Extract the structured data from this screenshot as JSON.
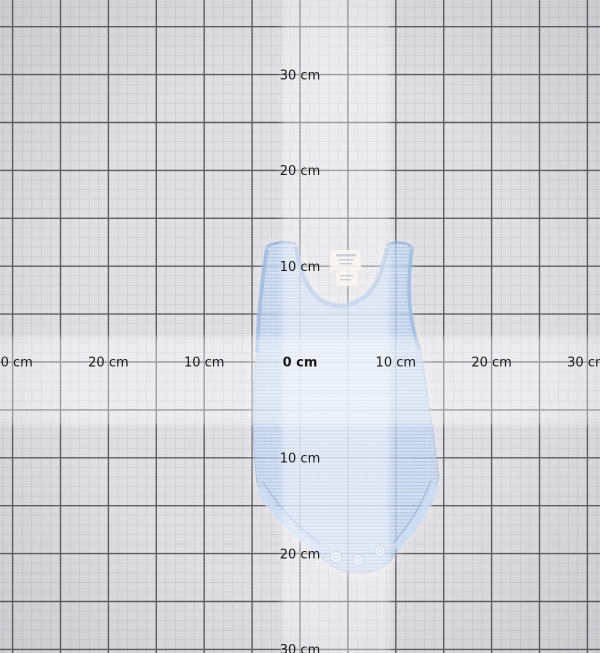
{
  "scene": {
    "title": "garment measurement grid",
    "width": 600,
    "height": 653,
    "background_color": "#dfdfe3",
    "vignette_color": "rgba(70,70,82,0.14)"
  },
  "grid": {
    "origin_x": 300,
    "origin_y": 362,
    "px_per_cm": 9.58,
    "minor_step_cm": 1,
    "major_step_cm": 5,
    "label_step_cm": 10,
    "minor_line_color": "#cbcbd1",
    "major_line_color": "#5d5d62",
    "minor_line_width": 0.7,
    "major_line_width": 1.4
  },
  "highlight_bands": {
    "vertical": {
      "x": 282,
      "width": 108
    },
    "horizontal": {
      "y": 337,
      "height": 88
    },
    "color": "rgba(255,255,255,0.40)"
  },
  "axes": {
    "unit": "cm",
    "label_font_size": 13,
    "label_color": "#1b1b1e",
    "horizontal_labels": [
      {
        "text": "30 cm",
        "cm": -30,
        "bold": false
      },
      {
        "text": "20 cm",
        "cm": -20,
        "bold": false
      },
      {
        "text": "10 cm",
        "cm": -10,
        "bold": false
      },
      {
        "text": "0 cm",
        "cm": 0,
        "bold": true
      },
      {
        "text": "10 cm",
        "cm": 10,
        "bold": false
      },
      {
        "text": "20 cm",
        "cm": 20,
        "bold": false
      },
      {
        "text": "30 cm",
        "cm": 30,
        "bold": false
      }
    ],
    "vertical_labels": [
      {
        "text": "30 cm",
        "cm": -30,
        "bold": false
      },
      {
        "text": "20 cm",
        "cm": -20,
        "bold": false
      },
      {
        "text": "10 cm",
        "cm": -10,
        "bold": false
      },
      {
        "text": "10 cm",
        "cm": 10,
        "bold": false
      },
      {
        "text": "20 cm",
        "cm": 20,
        "bold": false
      },
      {
        "text": "30 cm",
        "cm": 30,
        "bold": false
      }
    ]
  },
  "garment": {
    "name": "light blue striped sleeveless baby bodysuit",
    "opacity": 0.62,
    "stripe_light_color": "#c6d8f3",
    "stripe_dark_color": "#9dbbe6",
    "binding_color": "#9db9e0",
    "edge_color": "#93afd6",
    "fold_color": "#cdddf2",
    "tag_color": "#f5f3ec",
    "tag_edge_color": "#d9d5c7",
    "tag_text_color": "#a2a9b8",
    "snap_fill_color": "#e9eff8",
    "snap_ring_color": "#adc2e0",
    "snap_count": 3
  }
}
